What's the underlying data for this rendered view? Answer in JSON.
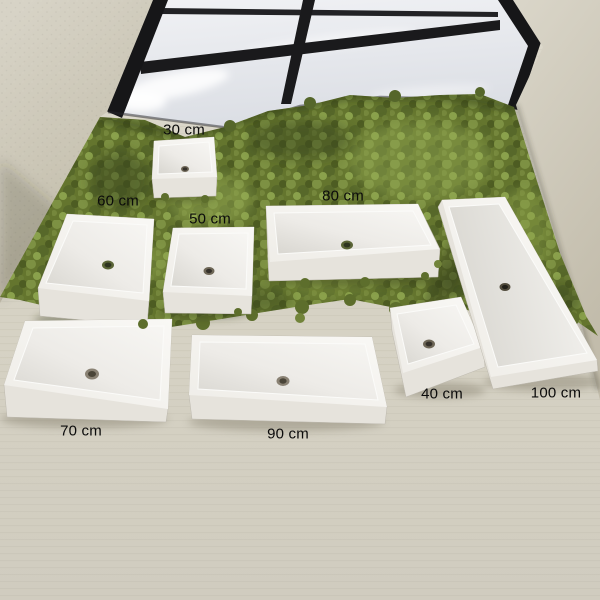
{
  "image_title": "White rectangular basins size comparison",
  "basins": [
    {
      "label": "30 cm"
    },
    {
      "label": "60 cm"
    },
    {
      "label": "50 cm"
    },
    {
      "label": "80 cm"
    },
    {
      "label": "40 cm"
    },
    {
      "label": "100 cm"
    },
    {
      "label": "70 cm"
    },
    {
      "label": "90 cm"
    }
  ],
  "colors": {
    "basin_white": "#f6f5f2",
    "basin_side": "#e6e3dc",
    "moss_green": "#64752e",
    "moss_light": "#8aa14c",
    "moss_dark": "#39451a",
    "floor_beige": "#d6d2c4",
    "wall_beige": "#c9c4b4",
    "window_frame_black": "#1a1a1c",
    "glass_grey": "#e8eaee",
    "label_text": "#0b0b0b"
  }
}
